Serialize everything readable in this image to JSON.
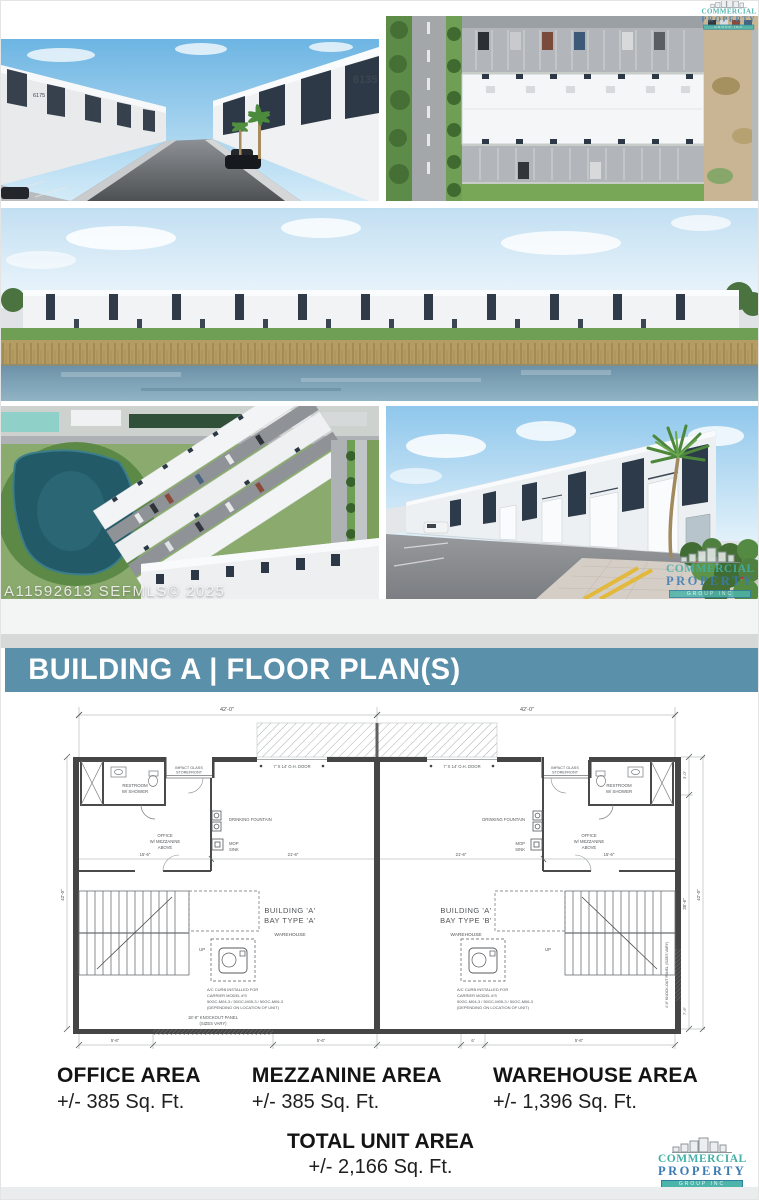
{
  "watermark": {
    "mls": "A11592613  SEFMLS© 2025"
  },
  "photos": {
    "building_left_number": "6175",
    "building_right_number": "6135"
  },
  "logo": {
    "line1": "COMMERCIAL",
    "line2": "PROPERTY",
    "line3": "GROUP INC"
  },
  "colors": {
    "header_band": "#5b90ab",
    "logo_teal": "#44b0a8",
    "logo_blue": "#3a7ab5",
    "building_accent": "#2e3947"
  },
  "header": {
    "title": "BUILDING A | FLOOR PLAN(S)"
  },
  "floorplan": {
    "bays": [
      {
        "building": "BUILDING 'A'",
        "bay": "BAY TYPE 'A'",
        "sub": "WAREHOUSE"
      },
      {
        "building": "BUILDING 'A'",
        "bay": "BAY TYPE 'B'",
        "sub": "WAREHOUSE"
      }
    ],
    "labels": {
      "restroom_1": "RESTROOM",
      "restroom_2": "W/ SHOWER",
      "office_1": "OFFICE",
      "office_2": "W/ MEZZANINE",
      "office_3": "ABOVE",
      "drinking_fountain": "DRINKING FOUNTAIN",
      "mop_1": "MOP",
      "mop_2": "SINK",
      "impact_1": "IMPACT GLASS",
      "impact_2": "STOREFRONT",
      "oh_door": "7' X 14' O.H. DOOR",
      "ac_1": "A/C CURB INSTALLED FOR",
      "ac_2": "CARRIER MODEL #'S",
      "ac_3": "50GC-M04-3 / 50GC-M05-3 / 50GC-M06-3",
      "ac_4": "(DEPENDING ON LOCATION OF UNIT)",
      "knockout_1": "18'-8\" KNOCKOUT PANEL",
      "knockout_2": "(SIZES VARY)",
      "knockout_right": "4'-6\" KNOCK-OUT PANEL (SIZES VARY)",
      "up": "UP"
    },
    "dims": {
      "top_left": "42'-0\"",
      "top_right": "42'-0\"",
      "left_height": "42'-0\"",
      "right_inner": "35'-6\"",
      "right_outer": "42'-0\"",
      "right_top": "3'-0\"",
      "right_bottom": "7'-6\"",
      "int_office": "15'-6\"",
      "int_warehouse": "21'-6\"",
      "bottom_a": "5'-6\"",
      "bottom_b": "5'-6\"",
      "bottom_c": "6'",
      "bottom_d": "5'-6\""
    }
  },
  "areas": {
    "items": [
      {
        "label": "OFFICE AREA",
        "value": "+/- 385 Sq. Ft."
      },
      {
        "label": "MEZZANINE AREA",
        "value": "+/- 385 Sq. Ft."
      },
      {
        "label": "WAREHOUSE AREA",
        "value": "+/- 1,396 Sq. Ft."
      }
    ],
    "total": {
      "label": "TOTAL UNIT AREA",
      "value": "+/- 2,166 Sq. Ft."
    }
  }
}
